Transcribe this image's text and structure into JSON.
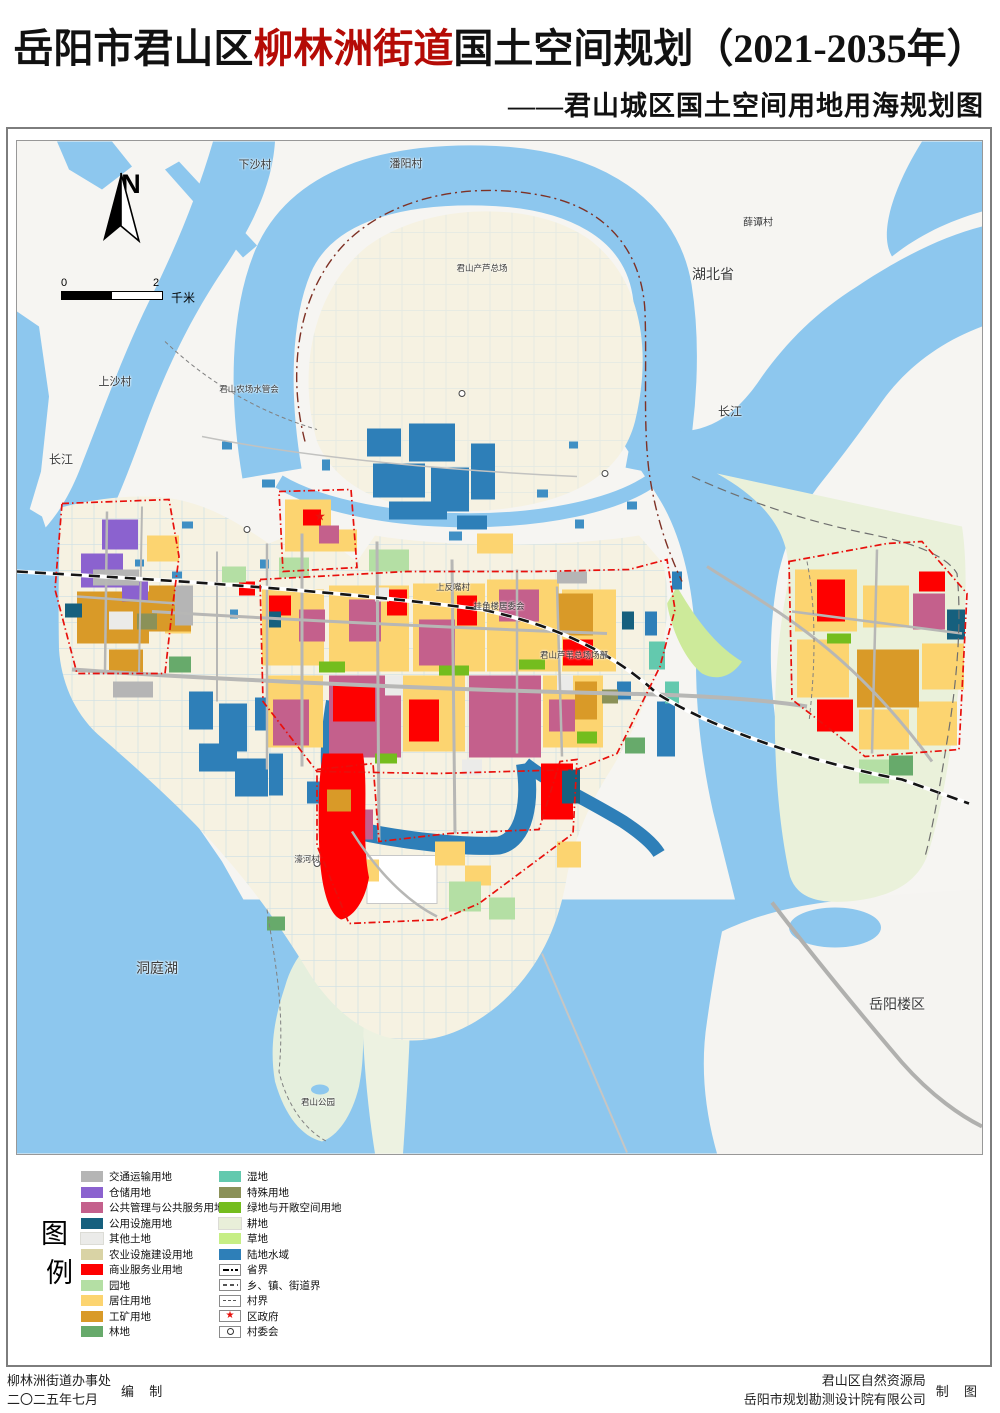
{
  "title": {
    "prefix": "岳阳市君山区",
    "highlight": "柳林洲街道",
    "suffix": "国土空间规划（2021-2035年）",
    "subtitle": "——君山城区国土空间用地用海规划图"
  },
  "map": {
    "north_label": "N",
    "scale": {
      "left": "0",
      "right": "2",
      "unit": "千米"
    },
    "colors": {
      "land": "#f6f5f2",
      "river": "#8dc7ee",
      "levee": "#f6f2e2",
      "plain": "#eaf1da",
      "park": "#e5efdd",
      "boundary_red": "#e8100c",
      "road": "#b7b7b5",
      "province_line": "#7e3125"
    },
    "labels": [
      {
        "text": "下沙村",
        "x": 238,
        "y": 23,
        "size": 11
      },
      {
        "text": "潘阳村",
        "x": 389,
        "y": 22,
        "size": 11
      },
      {
        "text": "薛谭村",
        "x": 741,
        "y": 80,
        "size": 10
      },
      {
        "text": "湖北省",
        "x": 696,
        "y": 133,
        "size": 14
      },
      {
        "text": "长江",
        "x": 713,
        "y": 270,
        "size": 12
      },
      {
        "text": "长江",
        "x": 44,
        "y": 318,
        "size": 12
      },
      {
        "text": "上沙村",
        "x": 98,
        "y": 240,
        "size": 11
      },
      {
        "text": "君山农场水管会",
        "x": 232,
        "y": 248,
        "size": 8.5
      },
      {
        "text": "君山产芦总场",
        "x": 465,
        "y": 127,
        "size": 8.5
      },
      {
        "text": "上反嘴村",
        "x": 436,
        "y": 446,
        "size": 8.5
      },
      {
        "text": "挂角楼居委会",
        "x": 482,
        "y": 465,
        "size": 8.5
      },
      {
        "text": "君山芦苇总场场部",
        "x": 557,
        "y": 514,
        "size": 8.5
      },
      {
        "text": "濠河村",
        "x": 290,
        "y": 718,
        "size": 8.5
      },
      {
        "text": "洞庭湖",
        "x": 140,
        "y": 827,
        "size": 14
      },
      {
        "text": "君山公园",
        "x": 301,
        "y": 961,
        "size": 8.5
      },
      {
        "text": "岳阳楼区",
        "x": 880,
        "y": 863,
        "size": 14
      }
    ]
  },
  "legend": {
    "title": "图例",
    "left": [
      {
        "key": "transport",
        "type": "swatch",
        "label": "交通运输用地",
        "color": "#b5b5b5"
      },
      {
        "key": "storage",
        "type": "swatch",
        "label": "仓储用地",
        "color": "#8b62cf"
      },
      {
        "key": "public_admin",
        "type": "swatch",
        "label": "公共管理与公共服务用地",
        "color": "#c4608c"
      },
      {
        "key": "utilities",
        "type": "swatch",
        "label": "公用设施用地",
        "color": "#16607e"
      },
      {
        "key": "other_land",
        "type": "swatch",
        "label": "其他土地",
        "color": "#ebebe9"
      },
      {
        "key": "agri_facility",
        "type": "swatch",
        "label": "农业设施建设用地",
        "color": "#d9d3a5"
      },
      {
        "key": "commercial",
        "type": "swatch",
        "label": "商业服务业用地",
        "color": "#fe0000"
      },
      {
        "key": "orchard",
        "type": "swatch",
        "label": "园地",
        "color": "#b4dfa4"
      },
      {
        "key": "residential",
        "type": "swatch",
        "label": "居住用地",
        "color": "#fcd470"
      },
      {
        "key": "industrial",
        "type": "swatch",
        "label": "工矿用地",
        "color": "#d99a28"
      },
      {
        "key": "forest",
        "type": "swatch",
        "label": "林地",
        "color": "#67aa6b"
      }
    ],
    "right": [
      {
        "key": "wetland",
        "type": "swatch",
        "label": "湿地",
        "color": "#63c9ae"
      },
      {
        "key": "special",
        "type": "swatch",
        "label": "特殊用地",
        "color": "#8b9158"
      },
      {
        "key": "green_open",
        "type": "swatch",
        "label": "绿地与开敞空间用地",
        "color": "#74bd1e"
      },
      {
        "key": "cropland",
        "type": "swatch",
        "label": "耕地",
        "color": "#e9efd9"
      },
      {
        "key": "grassland",
        "type": "swatch",
        "label": "草地",
        "color": "#c6ee85"
      },
      {
        "key": "water",
        "type": "swatch",
        "label": "陆地水域",
        "color": "#2e7fb8"
      },
      {
        "key": "province_boundary",
        "type": "line",
        "style": "province",
        "label": "省界"
      },
      {
        "key": "town_boundary",
        "type": "line",
        "style": "town",
        "label": "乡、镇、街道界"
      },
      {
        "key": "village_boundary",
        "type": "line",
        "style": "village",
        "label": "村界"
      },
      {
        "key": "district_gov",
        "type": "symbol",
        "style": "star",
        "label": "区政府"
      },
      {
        "key": "village_cmte",
        "type": "symbol",
        "style": "circle",
        "label": "村委会"
      }
    ]
  },
  "footer": {
    "left_lines": [
      "柳林洲街道办事处",
      "二〇二五年七月"
    ],
    "left_role": "编 制",
    "right_lines": [
      "君山区自然资源局",
      "岳阳市规划勘测设计院有限公司"
    ],
    "right_role": "制 图"
  }
}
